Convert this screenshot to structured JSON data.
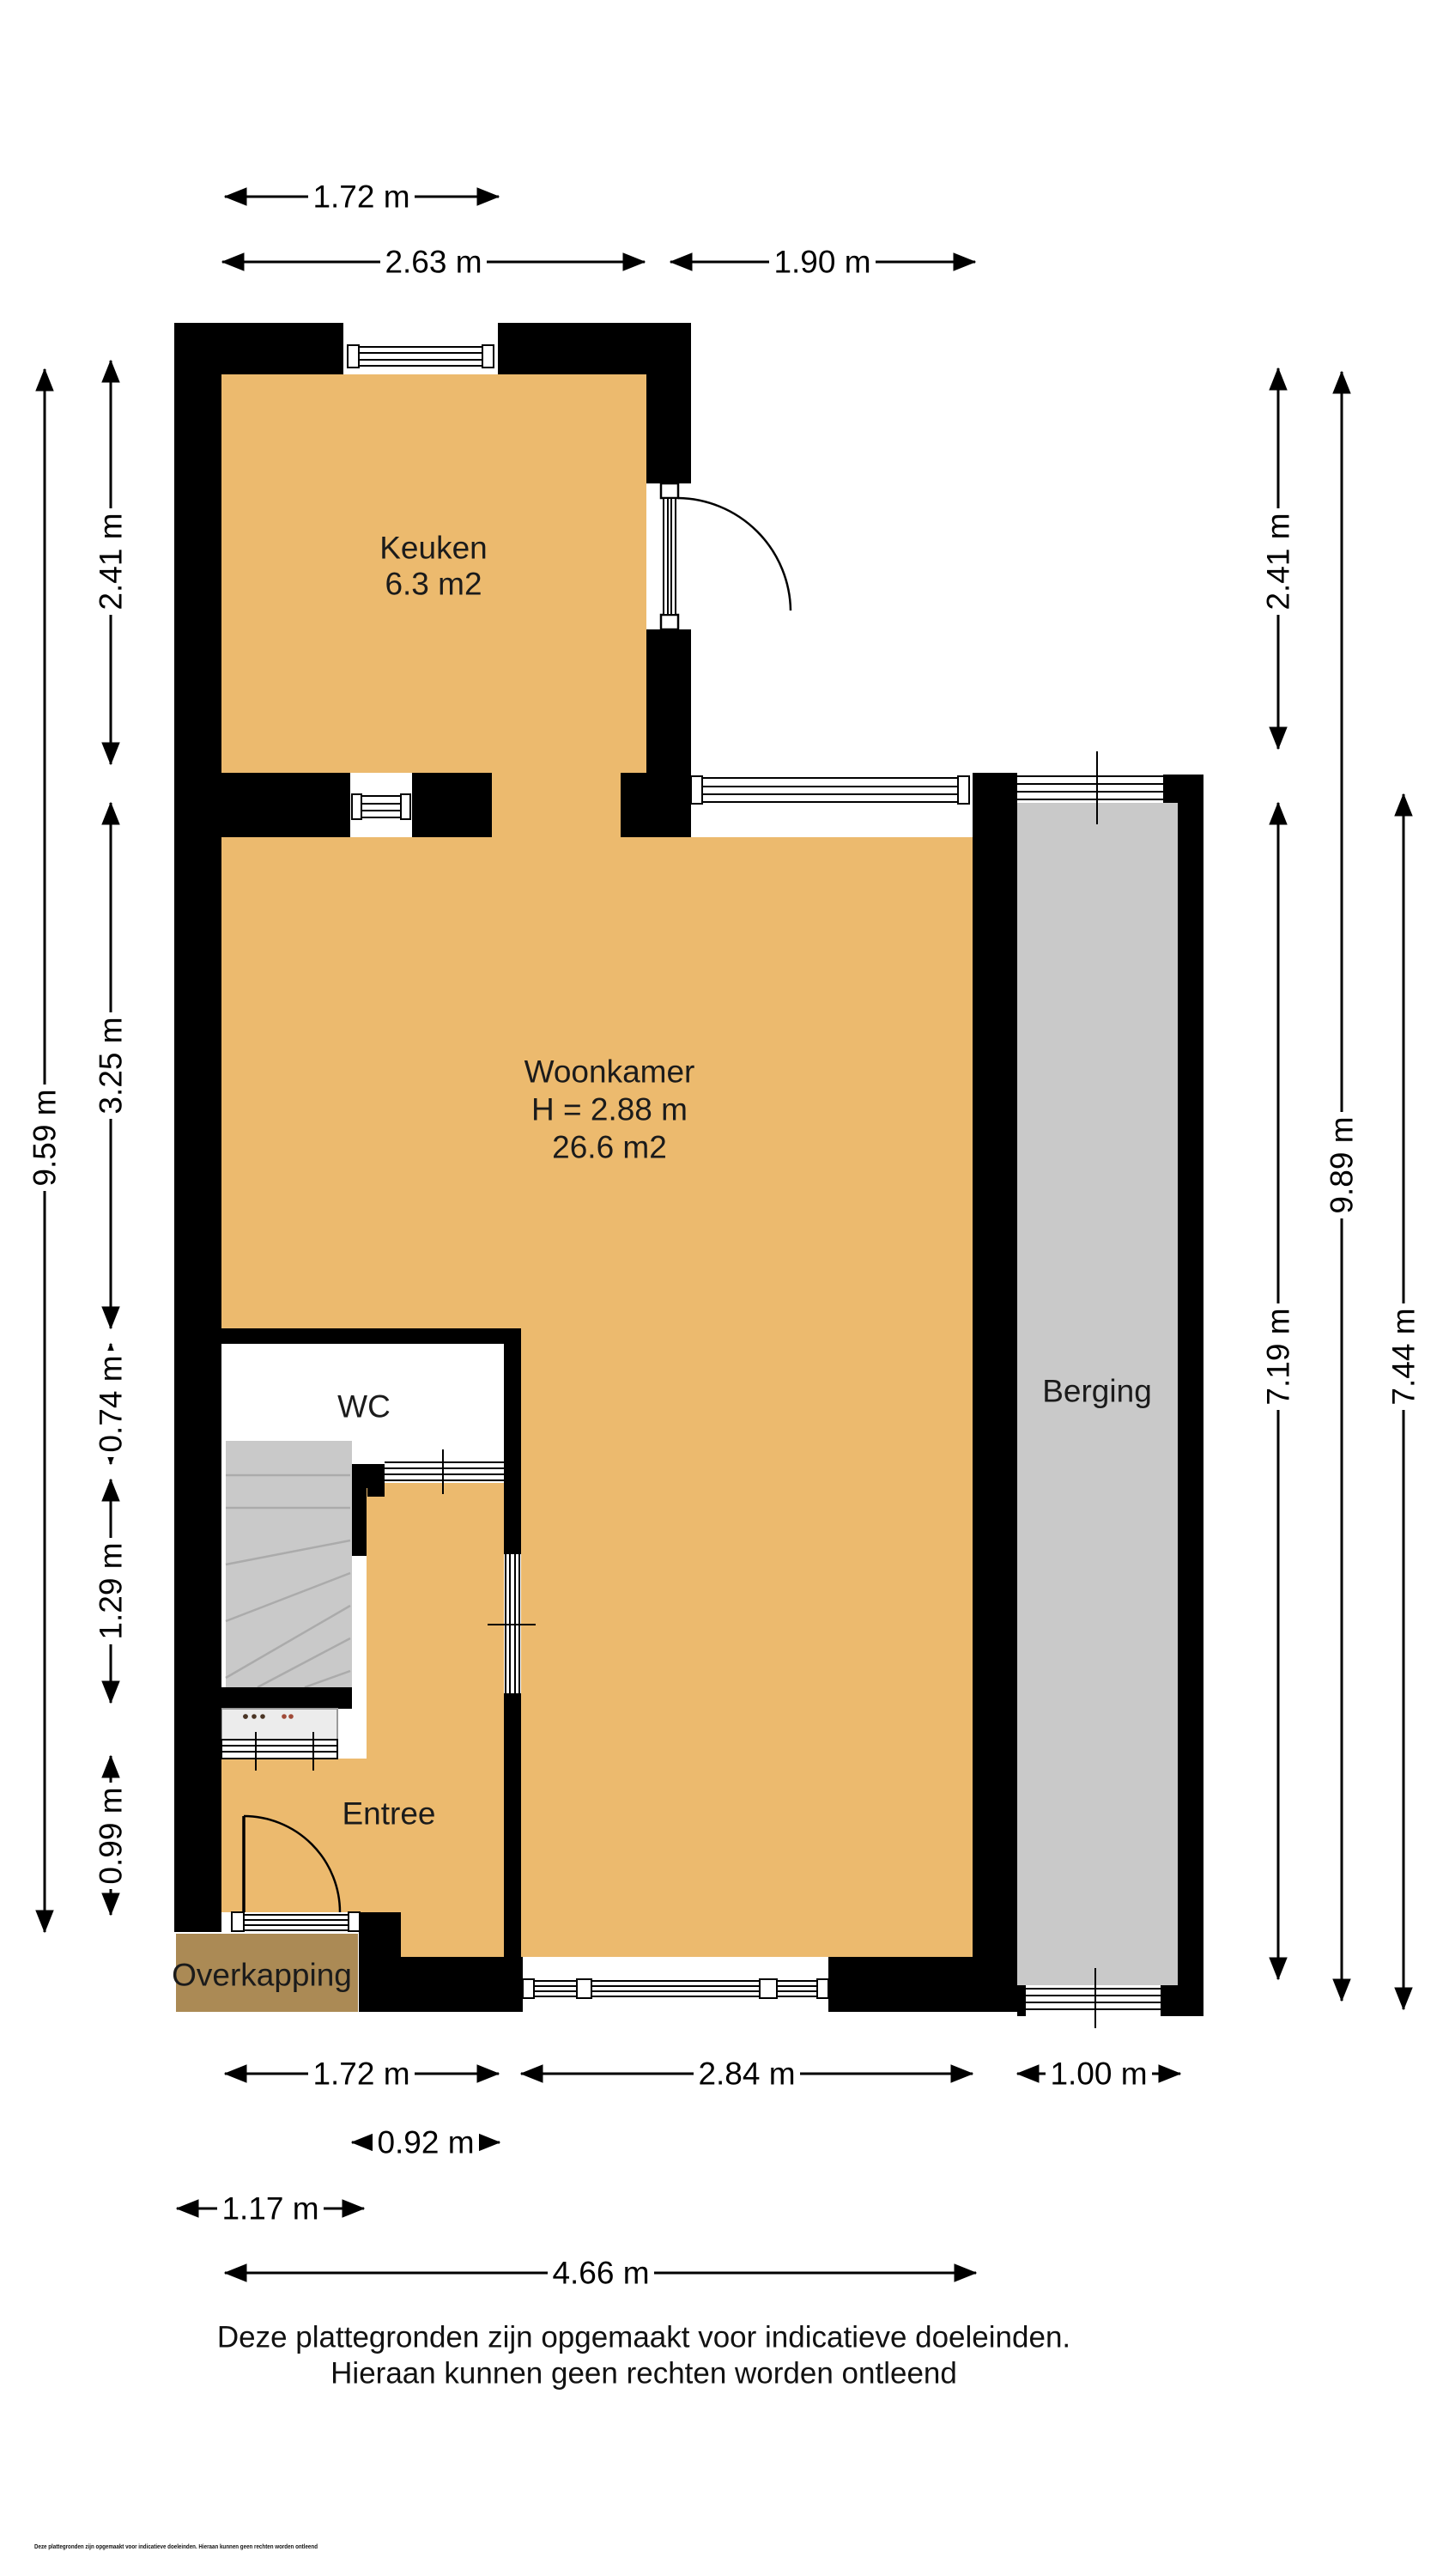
{
  "rooms": {
    "keuken": {
      "name": "Keuken",
      "area": "6.3 m2"
    },
    "woonkamer": {
      "name": "Woonkamer",
      "height": "H = 2.88 m",
      "area": "26.6 m2"
    },
    "wc": {
      "name": "WC"
    },
    "berging": {
      "name": "Berging"
    },
    "entree": {
      "name": "Entree"
    },
    "overkapping": {
      "name": "Overkapping"
    }
  },
  "dimensions": {
    "top": [
      "1.72 m",
      "2.63 m",
      "1.90 m"
    ],
    "left": [
      "9.59 m",
      "2.41 m",
      "3.25 m",
      "0.74 m",
      "1.29 m",
      "0.99 m"
    ],
    "right": [
      "2.41 m",
      "7.19 m",
      "9.89 m",
      "7.44 m"
    ],
    "bottom": [
      "1.72 m",
      "2.84 m",
      "1.00 m",
      "0.92 m",
      "1.17 m",
      "4.66 m"
    ]
  },
  "disclaimer": {
    "line1": "Deze plattegronden zijn opgemaakt voor indicatieve doeleinden.",
    "line2": "Hieraan kunnen geen rechten worden ontleend"
  },
  "fine_print": "Deze plattegronden zijn opgemaakt voor indicatieve doeleinden. Hieraan kunnen geen rechten worden ontleend",
  "colors": {
    "wall": "#000000",
    "floor": "#ecba6e",
    "storage": "#c9c9c9",
    "canopy": "#ab8a55"
  }
}
